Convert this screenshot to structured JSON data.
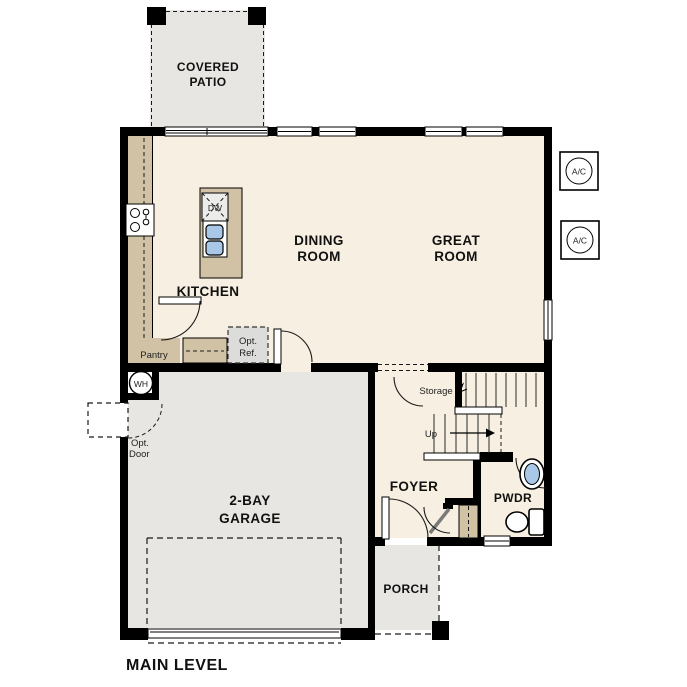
{
  "labels": {
    "covered_patio_1": "COVERED",
    "covered_patio_2": "PATIO",
    "dining_1": "DINING",
    "dining_2": "ROOM",
    "great_1": "GREAT",
    "great_2": "ROOM",
    "kitchen": "KITCHEN",
    "pantry": "Pantry",
    "opt_ref_1": "Opt.",
    "opt_ref_2": "Ref.",
    "dw": "DW",
    "wh": "WH",
    "ac_1": "A/C",
    "ac_2": "A/C",
    "storage": "Storage",
    "up": "Up",
    "opt_door_1": "Opt.",
    "opt_door_2": "Door",
    "garage_1": "2-BAY",
    "garage_2": "GARAGE",
    "foyer": "FOYER",
    "pwdr": "PWDR",
    "porch": "PORCH",
    "title": "MAIN LEVEL"
  },
  "colors": {
    "wall": "#000000",
    "floor_cream": "#f7efe1",
    "cabinet_tan": "#d2c2a5",
    "exterior_gray": "#e7e6e2",
    "opt_ref_gray": "#dcdcda",
    "fixture_blue": "#a9c7e6",
    "background": "#ffffff"
  }
}
